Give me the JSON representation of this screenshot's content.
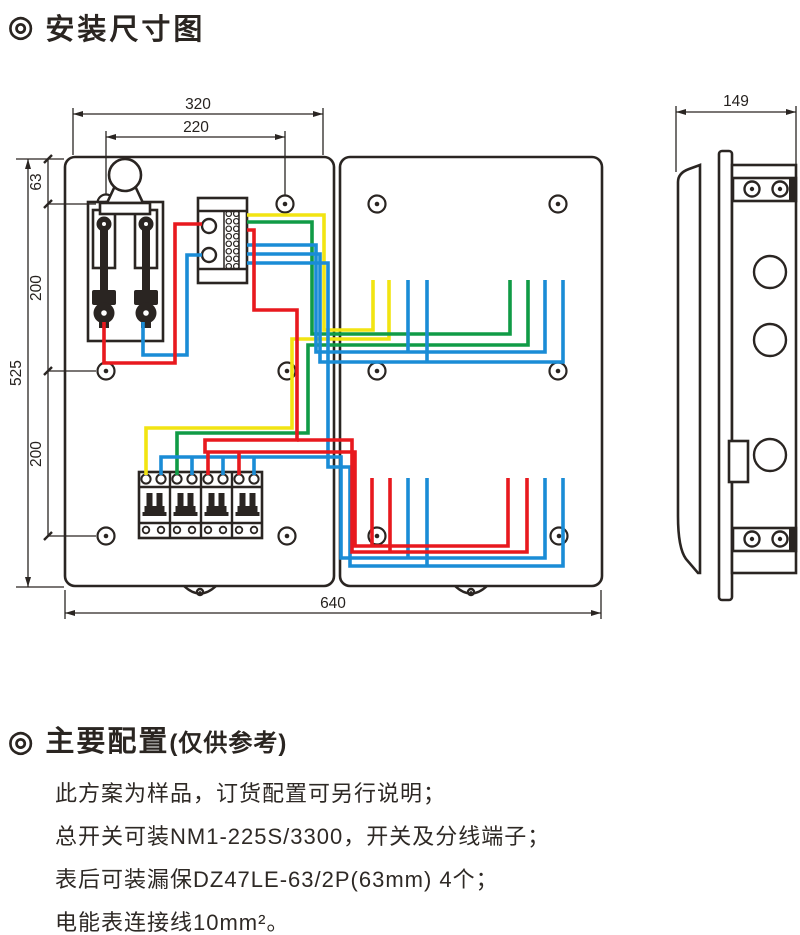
{
  "title_section": {
    "bullet": "◎",
    "title": "安装尺寸图"
  },
  "diagram": {
    "dimension_labels": {
      "front_width": "320",
      "hole_span": "220",
      "hole_top_offset": "63",
      "hole_mid_span": "200",
      "front_height": "525",
      "hole_lower_span": "200",
      "total_width": "640",
      "side_depth": "149"
    },
    "wire_colors": {
      "yellow": "#f2e412",
      "green": "#109b46",
      "red": "#e8191e",
      "blue": "#1a8cd6"
    },
    "line_color": "#2a2522"
  },
  "config_section": {
    "bullet": "◎",
    "heading": "主要配置",
    "heading_note": "(仅供参考)",
    "lines": [
      "此方案为样品，订货配置可另行说明；",
      "总开关可装NM1-225S/3300，开关及分线端子；",
      "表后可装漏保DZ47LE-63/2P(63mm) 4个；",
      "电能表连接线10mm²。"
    ]
  }
}
